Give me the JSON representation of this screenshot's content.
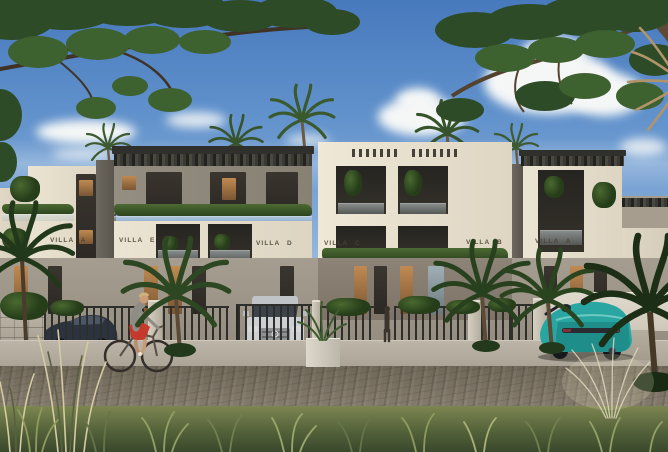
{
  "villas": [
    {
      "label": "VILLA A"
    },
    {
      "label": "VILLA E"
    },
    {
      "label": "VILLA D"
    },
    {
      "label": "VILLA C"
    },
    {
      "label": "VILLA B"
    },
    {
      "label": "VILLA A"
    }
  ],
  "palette": {
    "sky_top": "#4779bd",
    "sky_horizon": "#c9d8e8",
    "cloud_white": "#f5f7f6",
    "facade_cream": "#e4dcca",
    "facade_grey": "#8f897c",
    "pergola_dark": "#3a3a37",
    "foliage_dark": "#2c4722",
    "foliage_light": "#557239",
    "sidewalk_grey": "#b5aea1",
    "road_cobble": "#80776a",
    "grass_green": "#6d7a4a",
    "car_left_dark": "#2c3340",
    "car_suv_silver": "#ccd0d2",
    "car_sport_teal": "#29a6a1",
    "cyclist_shorts_red": "#c4392c"
  }
}
